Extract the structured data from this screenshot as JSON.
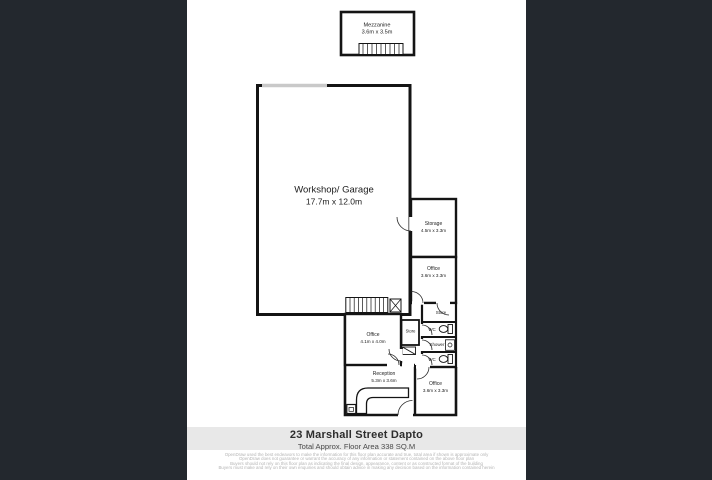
{
  "theme": {
    "side_panel_color": "#23282e",
    "sheet_color": "#ffffff",
    "wall_color": "#141414",
    "roller_door_color": "#c9c9c9",
    "banner_bg": "#e8e8e8",
    "banner_text_color": "#2d2d2d",
    "disclaimer_color": "#b5b5b5"
  },
  "floorplan": {
    "rooms": {
      "mezzanine": {
        "name": "Mezzanine",
        "dims": "3.6m x 3.5m"
      },
      "workshop": {
        "name": "Workshop/ Garage",
        "dims": "17.7m x 12.0m"
      },
      "storage": {
        "name": "Storage",
        "dims": "4.5m x 3.3m"
      },
      "office_right": {
        "name": "Office",
        "dims": "3.6m x 3.3m"
      },
      "store_right": {
        "name": "Store"
      },
      "wc_top": {
        "name": "WC"
      },
      "shower": {
        "name": "Shower"
      },
      "wc_bottom": {
        "name": "WC"
      },
      "office_mid": {
        "name": "Office",
        "dims": "4.1m x 4.0m"
      },
      "store_small": {
        "name": "Store"
      },
      "reception": {
        "name": "Reception",
        "dims": "5.3m x 3.6m"
      },
      "office_bottom": {
        "name": "Office",
        "dims": "3.6m x 3.3m"
      }
    }
  },
  "banner": {
    "title": "23 Marshall Street Dapto",
    "subtitle": "Total Approx. Floor Area 338 SQ.M"
  },
  "disclaimer": {
    "lines": [
      "OpenDraw used the best endeavors to make the information for this floor plan accurate and true, total area if shown is approximate only",
      "OpenDraw does not guarantee or warrant the accuracy of any information or statement contained on the above floor plan",
      "Buyers should not rely on this floor plan as indicating the final design, appearance, content or as constructed format of the building",
      "Buyers must make and rely on their own enquiries and should obtain advice in making any decision based on the information contained herein"
    ]
  }
}
